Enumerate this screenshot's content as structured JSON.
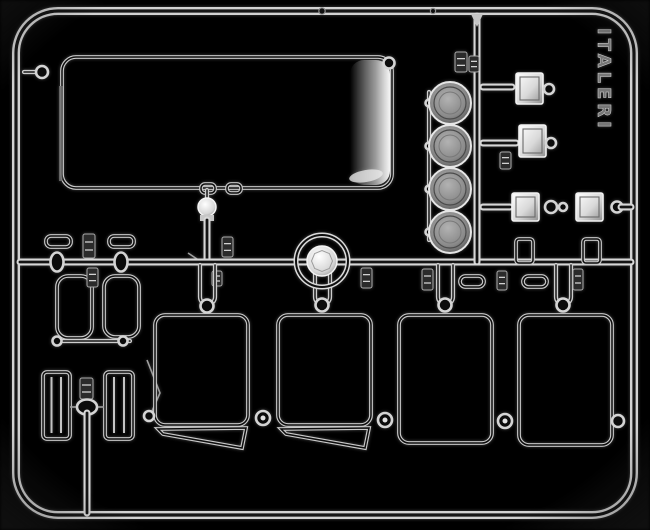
{
  "scene": {
    "description": "Photograph of a clear transparent injection-molded model kit sprue on a black background, containing windshield glass, window panes, headlight lenses and lamp parts",
    "background": "#000000",
    "embossed_text": "ITALERI",
    "palette": {
      "plastic_bright": "#f2f2f2",
      "plastic_mid": "#c9c9c9",
      "plastic_dim": "#6e6e6e",
      "shadow": "#141414"
    }
  },
  "shapes": [
    {
      "type": "tuberect",
      "name": "sprue-outer-frame",
      "x": 16,
      "y": 11,
      "w": 618,
      "h": 504,
      "rx": 42
    },
    {
      "type": "dot",
      "name": "frame-nub",
      "cls": "nubdot",
      "cx": 322,
      "cy": 11,
      "r": 3.2
    },
    {
      "type": "dot",
      "name": "frame-nub",
      "cls": "nubdot",
      "cx": 433,
      "cy": 11,
      "r": 2.6
    },
    {
      "type": "tube",
      "name": "windshield-gate-arm",
      "k": "t4",
      "x1": 24,
      "y1": 72,
      "x2": 36,
      "y2": 72
    },
    {
      "type": "ring",
      "name": "windshield-gate-ring",
      "cx": 42,
      "cy": 72,
      "r": 6
    },
    {
      "type": "outline",
      "name": "windshield-part",
      "x": 62,
      "y": 57,
      "w": 330,
      "h": 131,
      "rx": 14
    },
    {
      "type": "rectc",
      "name": "windshield-edge-highlight",
      "cls": "edgeglow",
      "x": 350,
      "y": 60,
      "w": 40,
      "h": 125,
      "rx": 14
    },
    {
      "type": "ellipsec",
      "name": "windshield-glare",
      "cls": "glare",
      "cx": 366,
      "cy": 176,
      "rx": 17,
      "ry": 6,
      "transform": "rotate(-10 366 176)"
    },
    {
      "type": "rectc",
      "name": "windshield-left-edge",
      "cls": "dimfill",
      "x": 59,
      "y": 86,
      "w": 3.5,
      "h": 95
    },
    {
      "type": "ring",
      "name": "windshield-gate-ring",
      "cx": 389,
      "cy": 63,
      "r": 5.5
    },
    {
      "type": "outline",
      "name": "windshield-bottom-gate",
      "x": 201,
      "y": 184,
      "w": 14,
      "h": 9,
      "rx": 4
    },
    {
      "type": "outline",
      "name": "windshield-bottom-gate",
      "x": 227,
      "y": 184,
      "w": 14,
      "h": 9,
      "rx": 4
    },
    {
      "type": "tube",
      "name": "dome-lamp-stem",
      "k": "t4",
      "x1": 207,
      "y1": 190,
      "x2": 207,
      "y2": 200
    },
    {
      "type": "bcirc",
      "name": "dome-lamp-part",
      "cx": 207,
      "cy": 207,
      "r": 9
    },
    {
      "type": "rectc",
      "name": "dome-lamp-collar",
      "cls": "metal",
      "x": 200,
      "y": 215,
      "w": 14,
      "h": 6
    },
    {
      "type": "tube",
      "name": "runner-vertical-left",
      "x1": 207,
      "y1": 220,
      "x2": 207,
      "y2": 262
    },
    {
      "type": "tag",
      "name": "part-number-tag",
      "x": 222,
      "y": 237,
      "w": 11,
      "h": 20
    },
    {
      "type": "thin",
      "name": "sprue-gate",
      "x1": 188,
      "y1": 253,
      "x2": 206,
      "y2": 265
    },
    {
      "type": "tag",
      "name": "part-number-tag",
      "x": 212,
      "y": 271,
      "w": 10,
      "h": 15
    },
    {
      "type": "tube",
      "name": "runner-horizontal-mid",
      "x1": 20,
      "y1": 262,
      "x2": 631,
      "y2": 262
    },
    {
      "type": "tubepath",
      "name": "pane-hanger-loop",
      "k": "t4",
      "d": "M200,265 L200,297 A7.5,7.5 0 0 0 215,297 L215,265"
    },
    {
      "type": "tubepath",
      "name": "pane-hanger-loop",
      "k": "t4",
      "d": "M315,265 L315,297 A7.5,7.5 0 0 0 330,297 L330,265"
    },
    {
      "type": "tubepath",
      "name": "pane-hanger-loop",
      "k": "t4",
      "d": "M438,265 L438,297 A7.5,7.5 0 0 0 453,297 L453,265"
    },
    {
      "type": "tubepath",
      "name": "pane-hanger-loop",
      "k": "t4",
      "d": "M556,265 L556,297 A7.5,7.5 0 0 0 571,297 L571,265"
    },
    {
      "type": "ring",
      "name": "pane-top-ring",
      "cx": 207,
      "cy": 306,
      "r": 6.5
    },
    {
      "type": "ring",
      "name": "pane-top-ring",
      "cx": 322,
      "cy": 305,
      "r": 6.5
    },
    {
      "type": "ring",
      "name": "pane-top-ring",
      "cx": 445,
      "cy": 305,
      "r": 6.5
    },
    {
      "type": "ring",
      "name": "pane-top-ring",
      "cx": 563,
      "cy": 305,
      "r": 6.5
    },
    {
      "type": "outline",
      "name": "small-tab-part",
      "x": 46,
      "y": 236,
      "w": 25,
      "h": 11,
      "rx": 5
    },
    {
      "type": "outline",
      "name": "small-tab-part",
      "x": 109,
      "y": 236,
      "w": 25,
      "h": 11,
      "rx": 5
    },
    {
      "type": "tag",
      "name": "part-number-tag",
      "x": 83,
      "y": 234,
      "w": 12,
      "h": 24
    },
    {
      "type": "oring",
      "name": "runner-connector",
      "cx": 57,
      "cy": 262,
      "rx": 6.5,
      "ry": 9.5
    },
    {
      "type": "oring",
      "name": "runner-connector",
      "cx": 121,
      "cy": 262,
      "rx": 6.5,
      "ry": 9.5
    },
    {
      "type": "outline",
      "name": "small-window-part",
      "x": 57,
      "y": 276,
      "w": 35,
      "h": 62,
      "rx": 11
    },
    {
      "type": "outline",
      "name": "small-window-part",
      "x": 104,
      "y": 276,
      "w": 35,
      "h": 61,
      "rx": 11
    },
    {
      "type": "tag",
      "name": "part-number-tag",
      "x": 87,
      "y": 268,
      "w": 11,
      "h": 19
    },
    {
      "type": "tube",
      "name": "small-window-bottom-bar",
      "k": "t4",
      "x1": 60,
      "y1": 341,
      "x2": 130,
      "y2": 341
    },
    {
      "type": "ring",
      "name": "bar-end-ring",
      "cx": 57,
      "cy": 341,
      "r": 4.5
    },
    {
      "type": "ring",
      "name": "bar-end-ring",
      "cx": 123,
      "cy": 341,
      "r": 4.5
    },
    {
      "type": "outline",
      "name": "louvered-step-part",
      "x": 43,
      "y": 372,
      "w": 27,
      "h": 67,
      "rx": 4
    },
    {
      "type": "line",
      "name": "louver-rib",
      "cls": "ribl",
      "x1": 51.5,
      "y1": 377,
      "x2": 51.5,
      "y2": 433
    },
    {
      "type": "line",
      "name": "louver-rib",
      "cls": "ribl",
      "x1": 61,
      "y1": 377,
      "x2": 61,
      "y2": 433
    },
    {
      "type": "outline",
      "name": "louvered-step-part",
      "x": 105,
      "y": 372,
      "w": 28,
      "h": 67,
      "rx": 4
    },
    {
      "type": "line",
      "name": "louver-rib",
      "cls": "ribl",
      "x1": 114,
      "y1": 377,
      "x2": 114,
      "y2": 433
    },
    {
      "type": "line",
      "name": "louver-rib",
      "cls": "ribl",
      "x1": 124,
      "y1": 377,
      "x2": 124,
      "y2": 433
    },
    {
      "type": "thin",
      "name": "sprue-gate",
      "x1": 70,
      "y1": 407,
      "x2": 82,
      "y2": 407
    },
    {
      "type": "thin",
      "name": "sprue-gate",
      "x1": 90,
      "y1": 407,
      "x2": 104,
      "y2": 407
    },
    {
      "type": "tag",
      "name": "part-number-tag",
      "x": 80,
      "y": 378,
      "w": 13,
      "h": 21
    },
    {
      "type": "oring",
      "name": "runner-knob",
      "cx": 87,
      "cy": 407,
      "rx": 10,
      "ry": 7.5
    },
    {
      "type": "tube",
      "name": "runner-vertical-bottom",
      "x1": 87,
      "y1": 413,
      "x2": 87,
      "y2": 513
    },
    {
      "type": "pathc",
      "name": "sprue-gate",
      "cls": "thinl",
      "d": "M147,360 L160,393 L149,418"
    },
    {
      "type": "outline",
      "name": "side-window-part",
      "x": 155,
      "y": 315,
      "w": 93,
      "h": 110,
      "rx": 10
    },
    {
      "type": "opoly",
      "name": "vent-window-part",
      "points": "158,429 246,428 242,448 163,434"
    },
    {
      "type": "outline",
      "name": "side-window-part",
      "x": 278,
      "y": 315,
      "w": 93,
      "h": 110,
      "rx": 10
    },
    {
      "type": "opoly",
      "name": "vent-window-part",
      "points": "281,429 369,428 365,448 286,434"
    },
    {
      "type": "outline",
      "name": "door-window-part",
      "x": 399,
      "y": 315,
      "w": 93,
      "h": 128,
      "rx": 10
    },
    {
      "type": "outline",
      "name": "door-window-part",
      "x": 519,
      "y": 315,
      "w": 93,
      "h": 130,
      "rx": 10
    },
    {
      "type": "ring",
      "name": "pane-link-ring",
      "cx": 149,
      "cy": 416,
      "r": 5
    },
    {
      "type": "ring",
      "name": "pane-link-ring",
      "cx": 263,
      "cy": 418,
      "r": 7
    },
    {
      "type": "dot",
      "name": "link-highlight",
      "cls": "glaredot",
      "cx": 263,
      "cy": 418,
      "r": 2.5
    },
    {
      "type": "ring",
      "name": "pane-link-ring",
      "cx": 385,
      "cy": 420,
      "r": 7
    },
    {
      "type": "dot",
      "name": "link-highlight",
      "cls": "glaredot",
      "cx": 385,
      "cy": 420,
      "r": 2.5
    },
    {
      "type": "ring",
      "name": "pane-link-ring",
      "cx": 505,
      "cy": 421,
      "r": 7
    },
    {
      "type": "dot",
      "name": "link-highlight",
      "cls": "glaredot",
      "cx": 505,
      "cy": 421,
      "r": 2.5
    },
    {
      "type": "ring",
      "name": "pane-link-ring",
      "cx": 618,
      "cy": 421,
      "r": 6
    },
    {
      "type": "tube",
      "name": "runner-vertical-right",
      "x1": 477,
      "y1": 16,
      "x2": 477,
      "y2": 262
    },
    {
      "type": "polyc",
      "name": "runner-junction",
      "cls": "metal",
      "points": "471,14 483,14 477,27"
    },
    {
      "type": "tag",
      "name": "part-number-tag",
      "x": 455,
      "y": 52,
      "w": 12,
      "h": 20
    },
    {
      "type": "tag",
      "name": "part-number-tag",
      "x": 469,
      "y": 56,
      "w": 10,
      "h": 16
    },
    {
      "type": "tube",
      "name": "lens-tie-bar",
      "k": "t4",
      "x1": 429,
      "y1": 92,
      "x2": 429,
      "y2": 240
    },
    {
      "type": "ring",
      "name": "tie-bar-ring",
      "cx": 429,
      "cy": 103,
      "r": 3.5,
      "sw": 1.8
    },
    {
      "type": "ring",
      "name": "tie-bar-ring",
      "cx": 429,
      "cy": 146,
      "r": 3.5,
      "sw": 1.8
    },
    {
      "type": "ring",
      "name": "tie-bar-ring",
      "cx": 429,
      "cy": 189,
      "r": 3.5,
      "sw": 1.8
    },
    {
      "type": "ring",
      "name": "tie-bar-ring",
      "cx": 429,
      "cy": 232,
      "r": 3.5,
      "sw": 1.8
    },
    {
      "type": "lens",
      "name": "headlight-lens-part",
      "cx": 450,
      "cy": 103,
      "r": 21
    },
    {
      "type": "lens",
      "name": "headlight-lens-part",
      "cx": 450,
      "cy": 146,
      "r": 21
    },
    {
      "type": "lens",
      "name": "headlight-lens-part",
      "cx": 450,
      "cy": 189,
      "r": 21
    },
    {
      "type": "lens",
      "name": "headlight-lens-part",
      "cx": 450,
      "cy": 232,
      "r": 21
    },
    {
      "type": "tube",
      "name": "lamp-arm",
      "x1": 483,
      "y1": 87,
      "x2": 512,
      "y2": 87
    },
    {
      "type": "sq",
      "name": "square-lamp-part",
      "x": 516,
      "y": 73,
      "w": 27,
      "h": 31
    },
    {
      "type": "ring",
      "name": "lamp-pin-ring",
      "cx": 549,
      "cy": 89,
      "r": 5
    },
    {
      "type": "tube",
      "name": "lamp-arm",
      "x1": 483,
      "y1": 143,
      "x2": 516,
      "y2": 143
    },
    {
      "type": "sq",
      "name": "square-lamp-part",
      "x": 519,
      "y": 125,
      "w": 27,
      "h": 32
    },
    {
      "type": "ring",
      "name": "lamp-pin-ring",
      "cx": 551,
      "cy": 143,
      "r": 5
    },
    {
      "type": "tag",
      "name": "part-number-tag",
      "x": 500,
      "y": 152,
      "w": 11,
      "h": 17
    },
    {
      "type": "tube",
      "name": "lamp-chain-arm",
      "x1": 483,
      "y1": 207,
      "x2": 510,
      "y2": 207
    },
    {
      "type": "sq",
      "name": "square-lamp-part",
      "x": 512,
      "y": 193,
      "w": 27,
      "h": 28
    },
    {
      "type": "ring",
      "name": "chain-link-ring",
      "cx": 551,
      "cy": 207,
      "r": 6
    },
    {
      "type": "ring",
      "name": "chain-link-ring",
      "cx": 563,
      "cy": 207,
      "r": 4
    },
    {
      "type": "sq",
      "name": "square-lamp-part",
      "x": 576,
      "y": 193,
      "w": 27,
      "h": 28
    },
    {
      "type": "ring",
      "name": "chain-link-ring",
      "cx": 617,
      "cy": 207,
      "r": 5.5
    },
    {
      "type": "tube",
      "name": "lamp-chain-arm",
      "x1": 621,
      "y1": 207,
      "x2": 631,
      "y2": 207
    },
    {
      "type": "outline",
      "name": "runner-stub",
      "x": 516,
      "y": 239,
      "w": 17,
      "h": 24,
      "rx": 3
    },
    {
      "type": "outline",
      "name": "runner-stub",
      "x": 583,
      "y": 239,
      "w": 17,
      "h": 24,
      "rx": 3
    },
    {
      "type": "outline",
      "name": "pill-lens-part",
      "x": 460,
      "y": 276,
      "w": 24,
      "h": 11,
      "rx": 5.5
    },
    {
      "type": "outline",
      "name": "pill-lens-part",
      "x": 523,
      "y": 276,
      "w": 24,
      "h": 11,
      "rx": 5.5
    },
    {
      "type": "tag",
      "name": "part-number-tag",
      "x": 422,
      "y": 269,
      "w": 11,
      "h": 21
    },
    {
      "type": "tag",
      "name": "part-number-tag",
      "x": 497,
      "y": 271,
      "w": 10,
      "h": 19
    },
    {
      "type": "tag",
      "name": "part-number-tag",
      "x": 573,
      "y": 269,
      "w": 10,
      "h": 21
    },
    {
      "type": "tag",
      "name": "part-number-tag",
      "x": 361,
      "y": 268,
      "w": 11,
      "h": 20
    },
    {
      "type": "tubecirc",
      "name": "beacon-lens-part",
      "cx": 322,
      "cy": 261,
      "r": 26
    },
    {
      "type": "bcirc",
      "name": "beacon-hub",
      "cx": 322,
      "cy": 261,
      "r": 15
    },
    {
      "type": "polyc",
      "name": "beacon-facets",
      "cls": "facet",
      "points": "332.5,261 329.4,268.4 322,271.5 314.6,268.4 311.5,261 314.6,253.6 322,250.5 329.4,253.6"
    },
    {
      "type": "text",
      "name": "sprue-embossed-text",
      "cls": "emboss",
      "x": 598,
      "y": 28,
      "transform": "rotate(90 598 28)",
      "bind": "scene.embossed_text"
    },
    {
      "type": "rectc",
      "name": "photo-vignette",
      "cls": "vig",
      "x": 0,
      "y": 0,
      "w": 650,
      "h": 530
    }
  ]
}
